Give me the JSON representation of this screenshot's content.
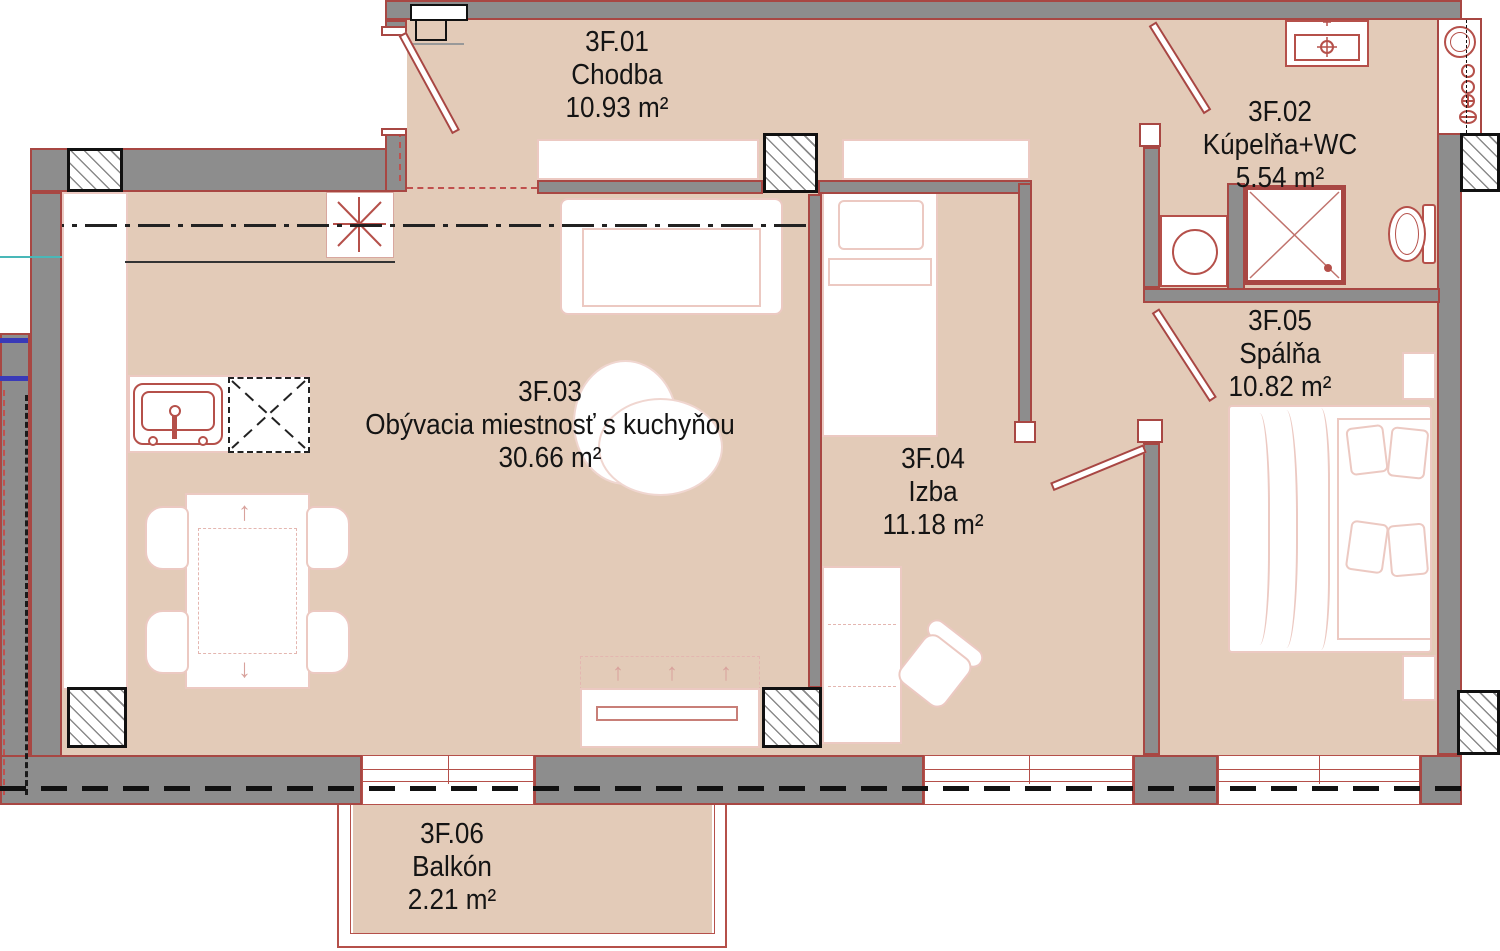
{
  "plan": {
    "type": "apartment-floor-plan",
    "rooms": [
      {
        "id": "3F.01",
        "name": "Chodba",
        "area": "10.93 m²"
      },
      {
        "id": "3F.02",
        "name": "Kúpelňa+WC",
        "area": "5.54 m²"
      },
      {
        "id": "3F.03",
        "name": "Obývacia miestnosť s kuchyňou",
        "area": "30.66 m²"
      },
      {
        "id": "3F.04",
        "name": "Izba",
        "area": "11.18 m²"
      },
      {
        "id": "3F.05",
        "name": "Spálňa",
        "area": "10.82 m²"
      },
      {
        "id": "3F.06",
        "name": "Balkón",
        "area": "2.21 m²"
      }
    ],
    "colors": {
      "floor": "#e3cbb8",
      "wall_fill": "#8d8d8d",
      "wall_outline": "#a84743",
      "fixture_red": "#b5504a",
      "furniture_outline": "#ecc9c2",
      "text": "#141414"
    }
  }
}
